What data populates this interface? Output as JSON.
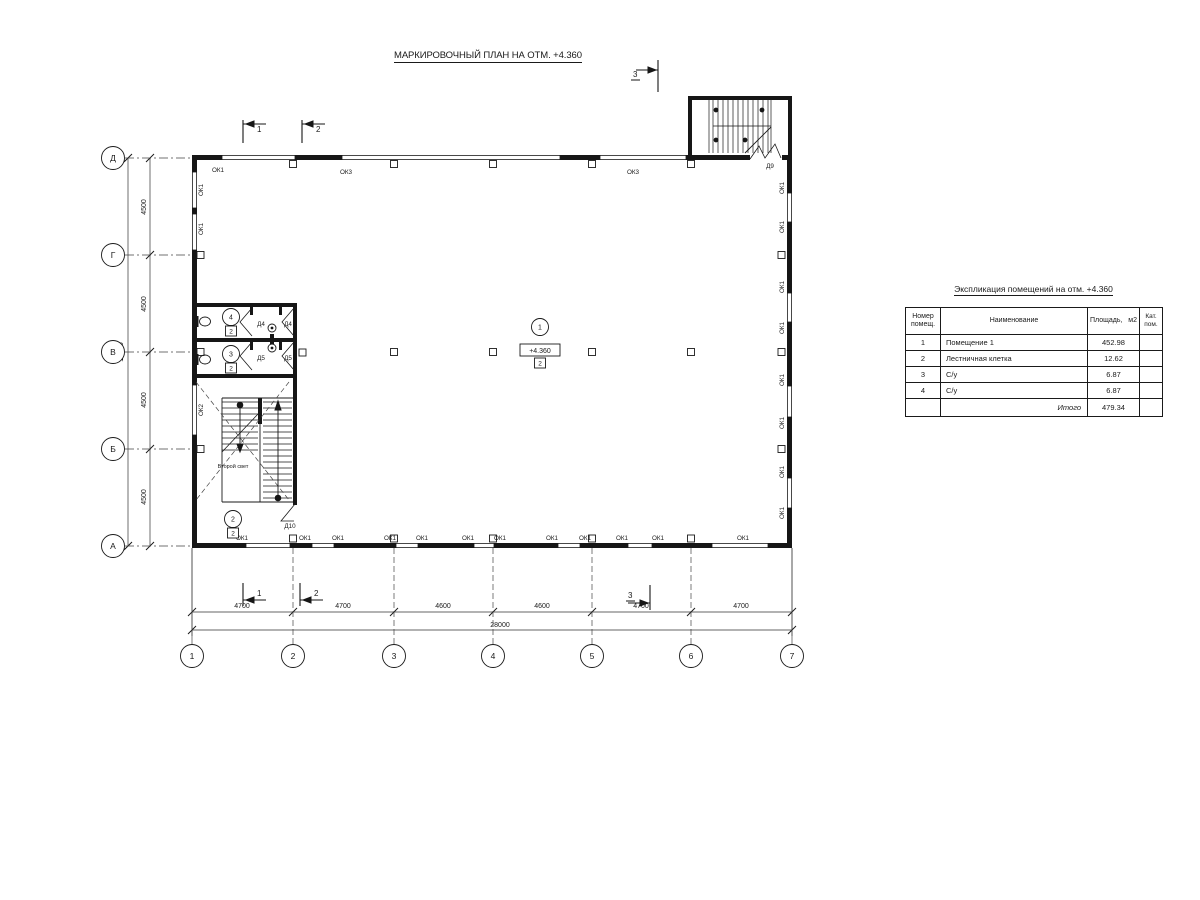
{
  "drawing_title": "МАРКИРОВОЧНЫЙ ПЛАН НА ОТМ. +4.360",
  "elevation_mark": "+4.360",
  "second_light_label": "Второй свет",
  "section_marks": {
    "t1": "1",
    "t2": "2",
    "t3": "3",
    "b1": "1",
    "b2": "2",
    "b3": "3"
  },
  "axis_rows": [
    {
      "label": "Д",
      "y": 158
    },
    {
      "label": "Г",
      "y": 255
    },
    {
      "label": "В",
      "y": 352
    },
    {
      "label": "Б",
      "y": 449
    },
    {
      "label": "А",
      "y": 546
    }
  ],
  "axis_cols": [
    {
      "label": "1",
      "x": 192
    },
    {
      "label": "2",
      "x": 293
    },
    {
      "label": "3",
      "x": 394
    },
    {
      "label": "4",
      "x": 493
    },
    {
      "label": "5",
      "x": 592
    },
    {
      "label": "6",
      "x": 691
    },
    {
      "label": "7",
      "x": 792
    }
  ],
  "dims_left": [
    {
      "text": "4500",
      "x": 146,
      "y": 207
    },
    {
      "text": "4500",
      "x": 146,
      "y": 304
    },
    {
      "text": "4500",
      "x": 146,
      "y": 400
    },
    {
      "text": "4500",
      "x": 146,
      "y": 497
    }
  ],
  "dim_left_total": {
    "text": "18000",
    "x": 123,
    "y": 352
  },
  "dims_bottom": [
    {
      "text": "4700",
      "x": 242
    },
    {
      "text": "4700",
      "x": 343
    },
    {
      "text": "4600",
      "x": 443
    },
    {
      "text": "4600",
      "x": 542
    },
    {
      "text": "4700",
      "x": 641
    },
    {
      "text": "4700",
      "x": 741
    }
  ],
  "dim_bottom_total": {
    "text": "28000",
    "x": 500,
    "y": 627
  },
  "window_labels": [
    {
      "text": "ОК1",
      "x": 218,
      "y": 172
    },
    {
      "text": "ОК3",
      "x": 346,
      "y": 174
    },
    {
      "text": "ОК3",
      "x": 633,
      "y": 174
    },
    {
      "text": "ОК1",
      "x": 242,
      "y": 540
    },
    {
      "text": "ОК1",
      "x": 305,
      "y": 540
    },
    {
      "text": "ОК1",
      "x": 338,
      "y": 540
    },
    {
      "text": "ОК1",
      "x": 390,
      "y": 540
    },
    {
      "text": "ОК1",
      "x": 422,
      "y": 540
    },
    {
      "text": "ОК1",
      "x": 468,
      "y": 540
    },
    {
      "text": "ОК1",
      "x": 500,
      "y": 540
    },
    {
      "text": "ОК1",
      "x": 552,
      "y": 540
    },
    {
      "text": "ОК1",
      "x": 585,
      "y": 540
    },
    {
      "text": "ОК1",
      "x": 622,
      "y": 540
    },
    {
      "text": "ОК1",
      "x": 658,
      "y": 540
    },
    {
      "text": "ОК1",
      "x": 743,
      "y": 540
    },
    {
      "text": "ОК1",
      "x": 203,
      "y": 190,
      "rot": true
    },
    {
      "text": "ОК1",
      "x": 203,
      "y": 229,
      "rot": true
    },
    {
      "text": "ОК2",
      "x": 203,
      "y": 410,
      "rot": true
    },
    {
      "text": "ОК1",
      "x": 784,
      "y": 188,
      "rot": true
    },
    {
      "text": "ОК1",
      "x": 784,
      "y": 227,
      "rot": true
    },
    {
      "text": "ОК1",
      "x": 784,
      "y": 287,
      "rot": true
    },
    {
      "text": "ОК1",
      "x": 784,
      "y": 328,
      "rot": true
    },
    {
      "text": "ОК1",
      "x": 784,
      "y": 380,
      "rot": true
    },
    {
      "text": "ОК1",
      "x": 784,
      "y": 423,
      "rot": true
    },
    {
      "text": "ОК1",
      "x": 784,
      "y": 472,
      "rot": true
    },
    {
      "text": "ОК1",
      "x": 784,
      "y": 513,
      "rot": true
    }
  ],
  "door_labels": [
    {
      "text": "Д4",
      "x": 261,
      "y": 326
    },
    {
      "text": "Д4",
      "x": 288,
      "y": 326
    },
    {
      "text": "Д5",
      "x": 261,
      "y": 360
    },
    {
      "text": "Д5",
      "x": 288,
      "y": 360
    },
    {
      "text": "Д9",
      "x": 770,
      "y": 168
    },
    {
      "text": "Д10",
      "x": 290,
      "y": 528
    }
  ],
  "room_tags": [
    {
      "num": "1",
      "cat": "2",
      "x": 540,
      "y": 327,
      "elevation": true
    },
    {
      "num": "2",
      "cat": "2",
      "x": 233,
      "y": 519
    },
    {
      "num": "3",
      "cat": "2",
      "x": 231,
      "y": 354
    },
    {
      "num": "4",
      "cat": "2",
      "x": 231,
      "y": 317
    }
  ],
  "schedule": {
    "title": "Экспликация помещений на отм. +4.360",
    "col_headers": [
      "Номер\nпомещ.",
      "Наименование",
      "Площадь,   м2",
      "Кат.\nпом."
    ],
    "rows": [
      {
        "num": "1",
        "name": "Помещение 1",
        "area": "452.98",
        "cat": ""
      },
      {
        "num": "2",
        "name": "Лестничная клетка",
        "area": "12.62",
        "cat": ""
      },
      {
        "num": "3",
        "name": "С/у",
        "area": "6.87",
        "cat": ""
      },
      {
        "num": "4",
        "name": "С/у",
        "area": "6.87",
        "cat": ""
      }
    ],
    "total_label": "Итого",
    "total_value": "479.34"
  }
}
